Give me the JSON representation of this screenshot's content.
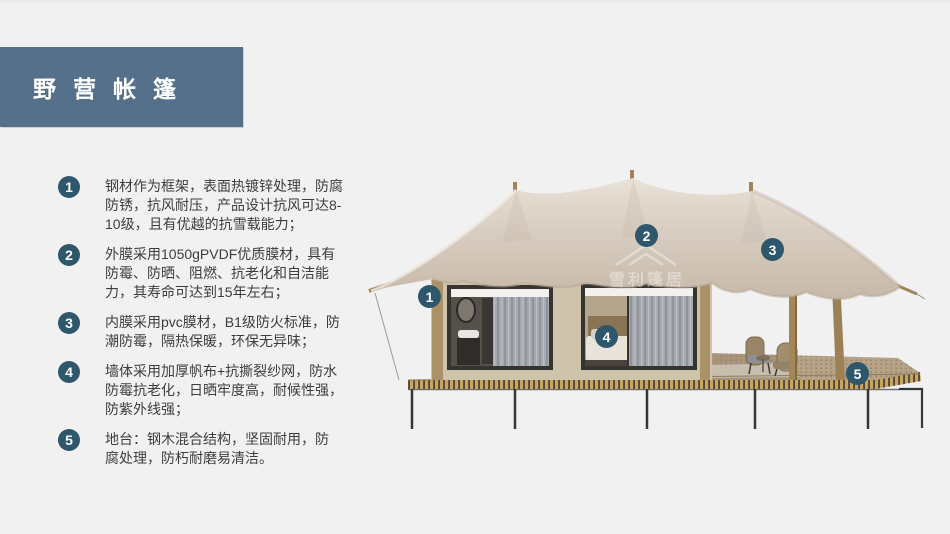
{
  "header": {
    "title": "野营帐篷"
  },
  "features": [
    {
      "number": "1",
      "text": "钢材作为框架，表面热镀锌处理，防腐\n防锈，抗风耐压，产品设计抗风可达8-\n10级，且有优越的抗雪载能力；"
    },
    {
      "number": "2",
      "text": "外膜采用1050gPVDF优质膜材，具有\n防霉、防晒、阻燃、抗老化和自洁能\n力，其寿命可达到15年左右；"
    },
    {
      "number": "3",
      "text": "内膜采用pvc膜材，B1级防火标准，防\n潮防霉，隔热保暖，环保无异味；"
    },
    {
      "number": "4",
      "text": "墙体采用加厚帆布+抗撕裂纱网，防水\n防霉抗老化，日晒牢度高，耐候性强，\n防紫外线强；"
    },
    {
      "number": "5",
      "text": "地台：钢木混合结构，坚固耐用，防\n腐处理，防朽耐磨易清洁。"
    }
  ],
  "image": {
    "watermark": "雪利篷居",
    "callouts": [
      {
        "label": "1"
      },
      {
        "label": "2"
      },
      {
        "label": "3"
      },
      {
        "label": "4"
      },
      {
        "label": "5"
      }
    ]
  },
  "colors": {
    "background": "#F1F1F2",
    "banner": "#54708A",
    "badge": "#2E576C",
    "body_text": "#3D3D3D",
    "canopy": "#D8CDC1",
    "cabin_wall": "#D0C3AC",
    "deck_slat": "#C9A660"
  }
}
